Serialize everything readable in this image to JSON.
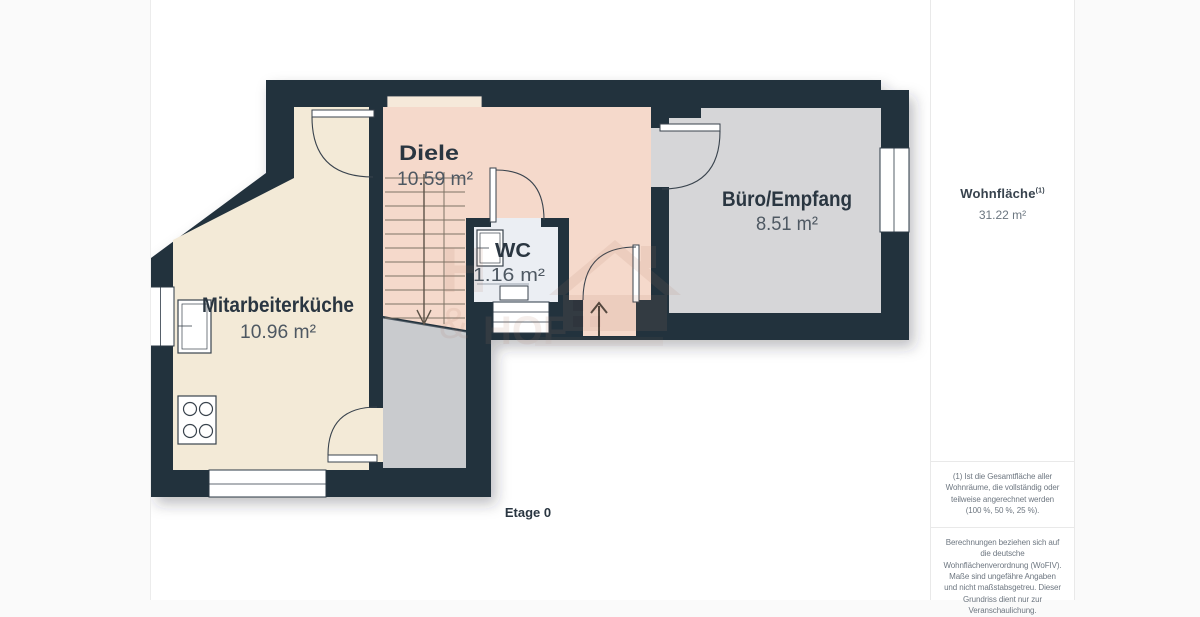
{
  "floorplan": {
    "level_label": "Etage 0",
    "rooms": {
      "diele": {
        "name": "Diele",
        "area": "10.59 m²"
      },
      "kitchen": {
        "name": "Mitarbeiterküche",
        "area": "10.96 m²"
      },
      "wc": {
        "name": "WC",
        "area": "1.16 m²"
      },
      "buero": {
        "name": "Büro/Empfang",
        "area": "8.51 m²"
      }
    },
    "colors": {
      "wall": "#20303e",
      "diele_floor": "#f5d9cb",
      "kitchen_floor": "#f3ead7",
      "buero_floor": "#d6d6d8",
      "wc_floor": "#ebeef3",
      "understairs_floor": "#c9cbce"
    },
    "watermark": {
      "letter_h": "H",
      "ampersand": "&",
      "word_hof": "HOF"
    }
  },
  "sidebar": {
    "total_area_label": "Wohnfläche",
    "total_area_footnote_marker": "(1)",
    "total_area_value": "31.22 m²",
    "footnote_1": "(1) Ist die Gesamtfläche aller Wohnräume, die vollständig oder teilweise angerechnet werden (100 %, 50 %, 25 %).",
    "footnote_2": "Berechnungen beziehen sich auf die deutsche Wohnflächenverordnung (WoFIV). Maße sind ungefähre Angaben und nicht maßstabsgetreu. Dieser Grundriss dient nur zur Veranschaulichung."
  }
}
